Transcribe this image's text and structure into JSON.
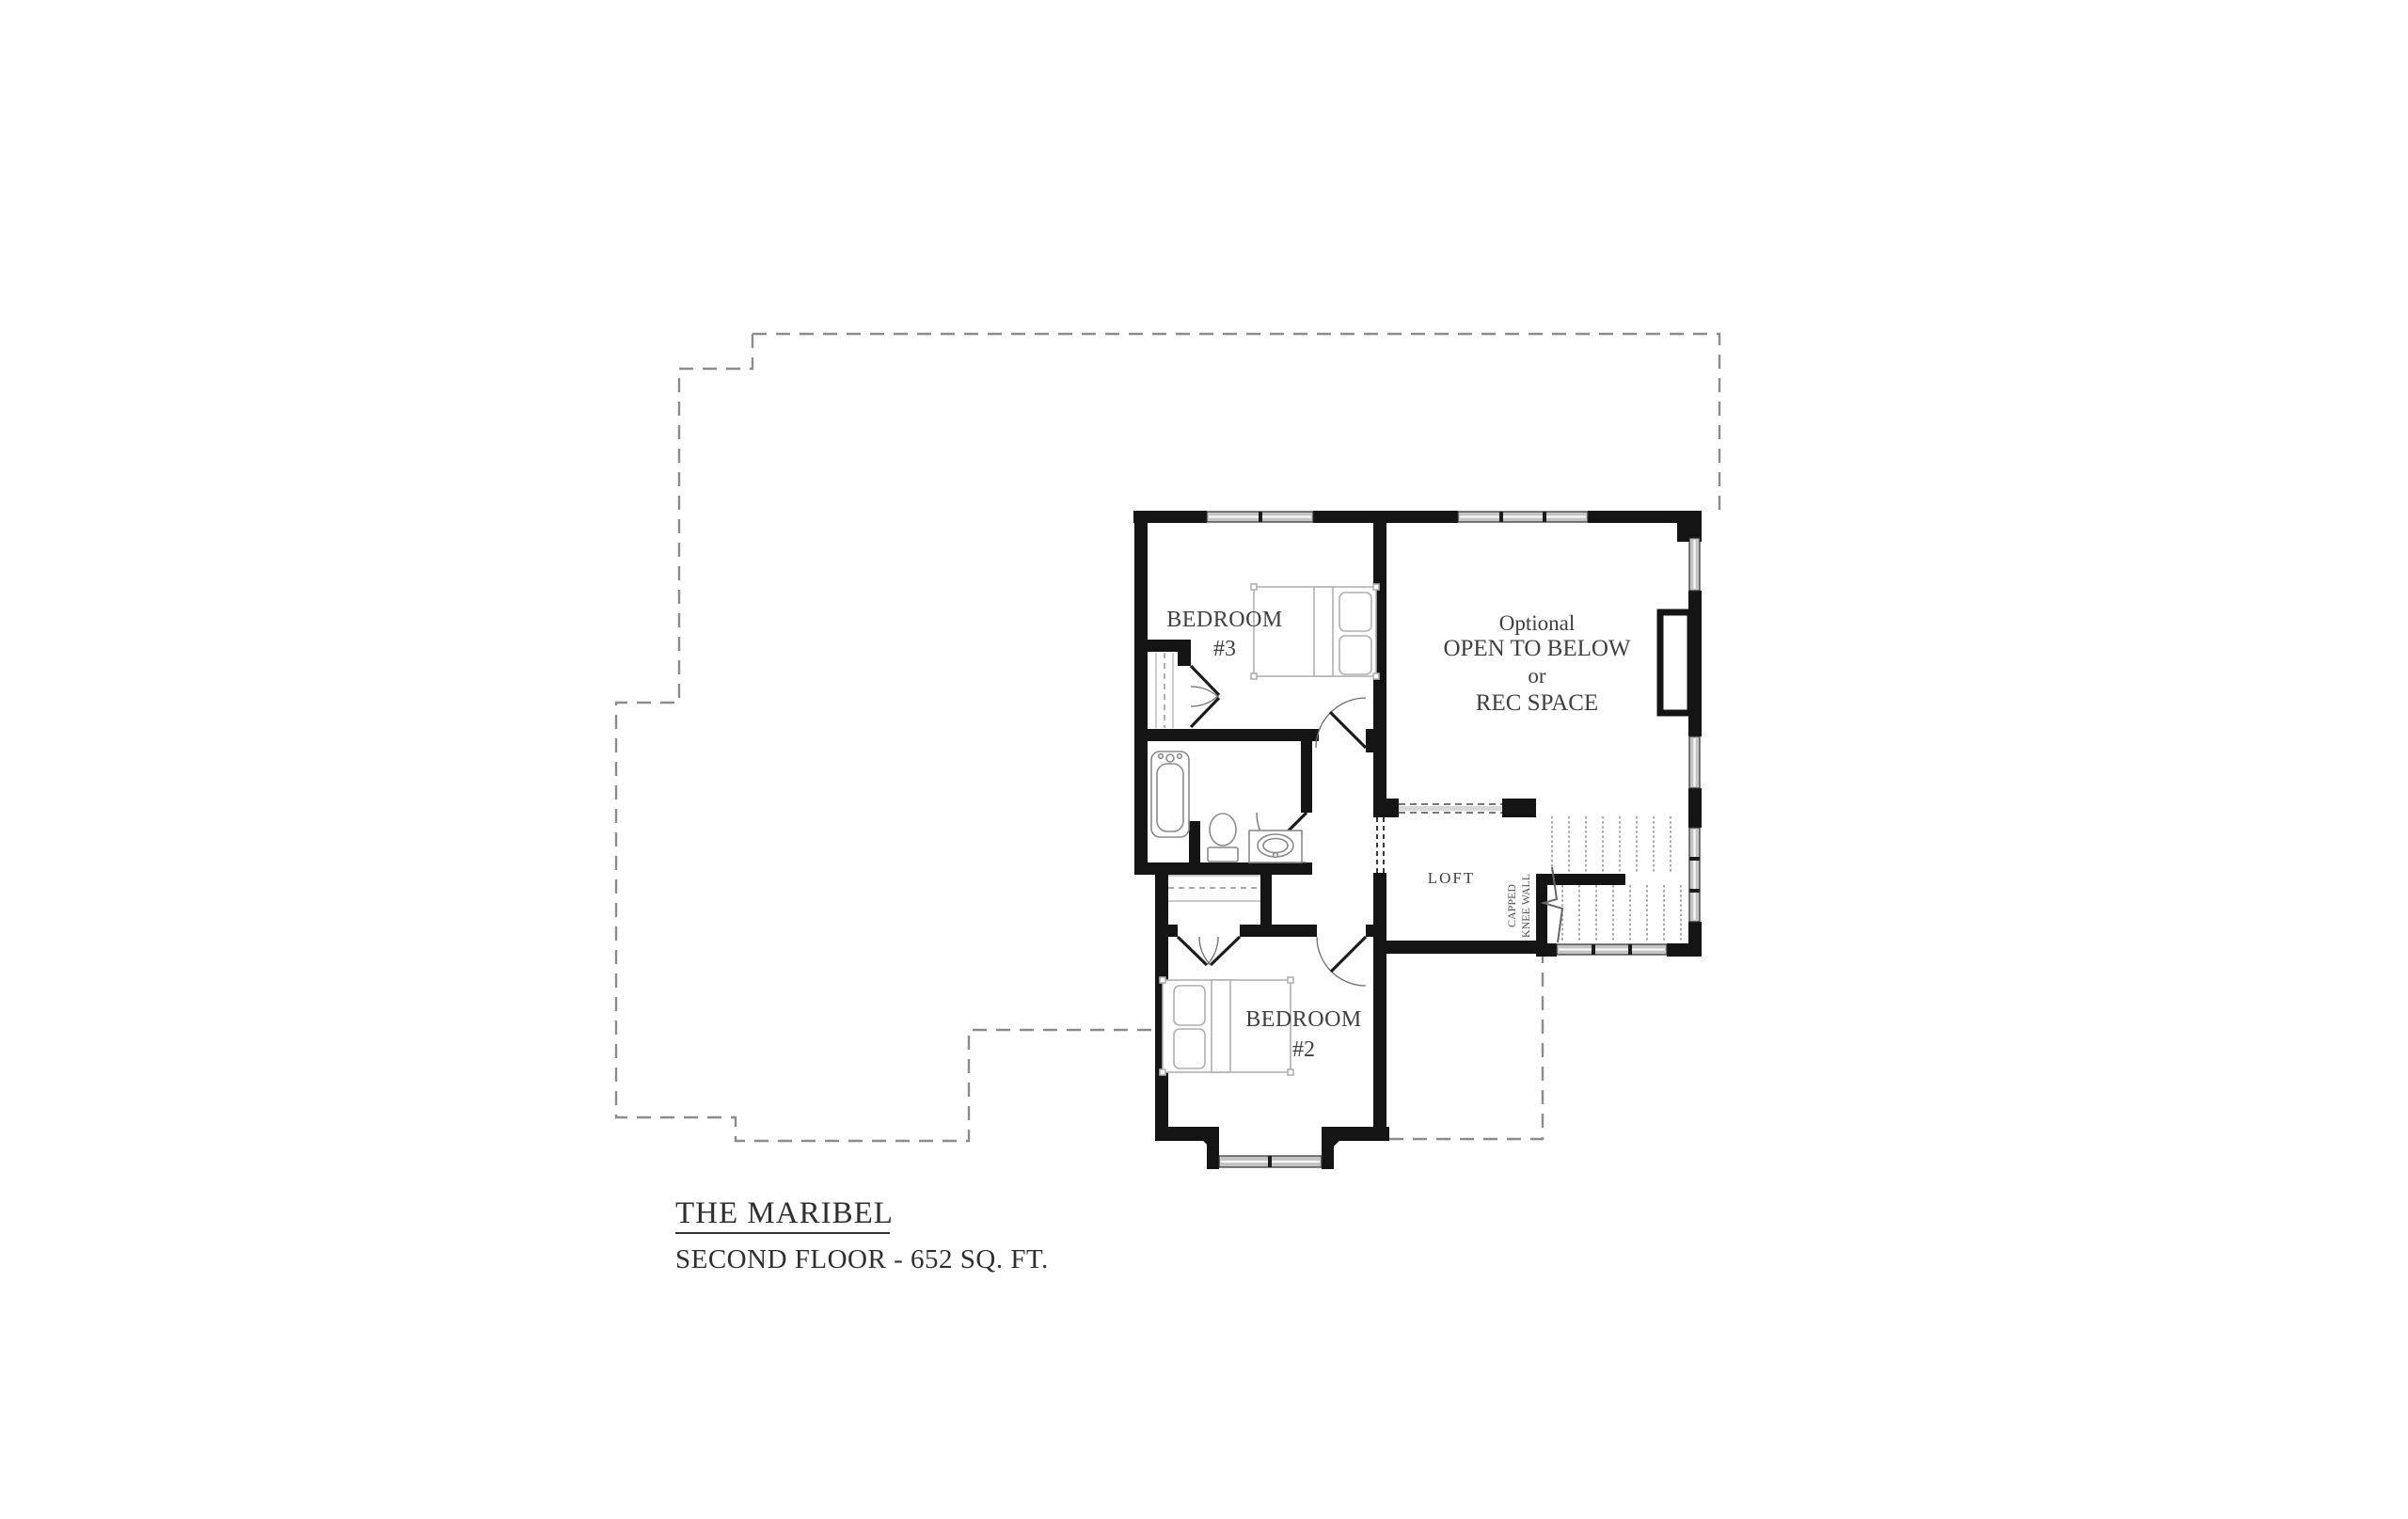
{
  "colors": {
    "page-bg": "#ffffff",
    "wall": "#141414",
    "label-text": "#404040",
    "title-text": "#2f2f2f",
    "furniture-line": "#b0b0b0",
    "fixture-line": "#8a8a8a",
    "window-fill": "#c4c4c4",
    "outline-dash": "#8c8c8c"
  },
  "plan": {
    "bedroom3": {
      "name_line1": "BEDROOM",
      "name_line2": "#3"
    },
    "bedroom2": {
      "name_line1": "BEDROOM",
      "name_line2": "#2"
    },
    "rec_space": {
      "line1": "Optional",
      "line2": "OPEN TO BELOW",
      "line3": "or",
      "line4": "REC SPACE"
    },
    "loft": {
      "name": "LOFT"
    },
    "stair_note": {
      "line1": "CAPPED",
      "line2": "KNEE WALL"
    }
  },
  "title_block": {
    "plan_name": "THE MARIBEL",
    "floor_label": "SECOND FLOOR - 652 SQ. FT."
  }
}
